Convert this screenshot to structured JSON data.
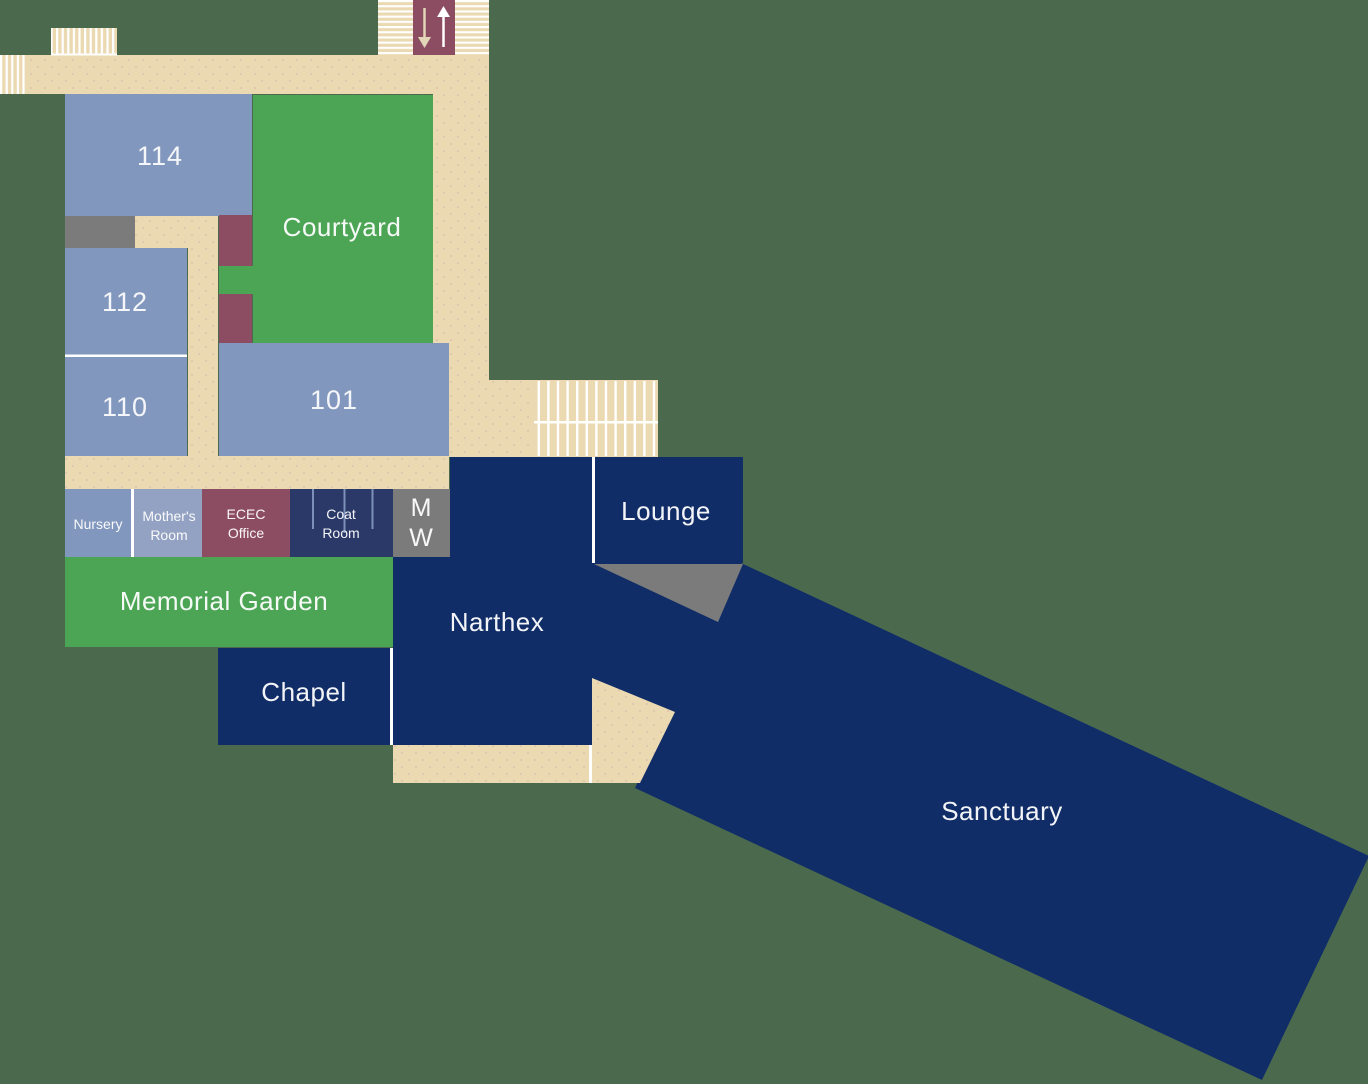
{
  "labels": {
    "r114": "114",
    "r112": "112",
    "r110": "110",
    "r101": "101",
    "courtyard": "Courtyard",
    "nursery": "Nursery",
    "mothers_line1": "Mother's",
    "mothers_line2": "Room",
    "ecec_line1": "ECEC",
    "ecec_line2": "Office",
    "coat_line1": "Coat",
    "coat_line2": "Room",
    "restroom_m": "M",
    "restroom_w": "W",
    "memorial_garden": "Memorial Garden",
    "chapel": "Chapel",
    "narthex": "Narthex",
    "lounge": "Lounge",
    "sanctuary": "Sanctuary"
  },
  "icons": {
    "elevator_down": "down-arrow",
    "elevator_up": "up-arrow",
    "stairs": "striped-treads"
  },
  "colors": {
    "background": "#4B6A4D",
    "corridor": "#EBD9B2",
    "corridor_dot": "#DCC2AE",
    "room_blue": "#8297BD",
    "room_blue_light": "#93A2C2",
    "green": "#4CA455",
    "maroon": "#8C4D62",
    "navy": "#112D67",
    "coat_navy": "#2A3968",
    "coat_line": "#7C90BA",
    "gray": "#7B7B7B",
    "white": "#FFFFFF",
    "arrow_beige": "#E3D6B8",
    "label_text": "#FFFFFF"
  }
}
